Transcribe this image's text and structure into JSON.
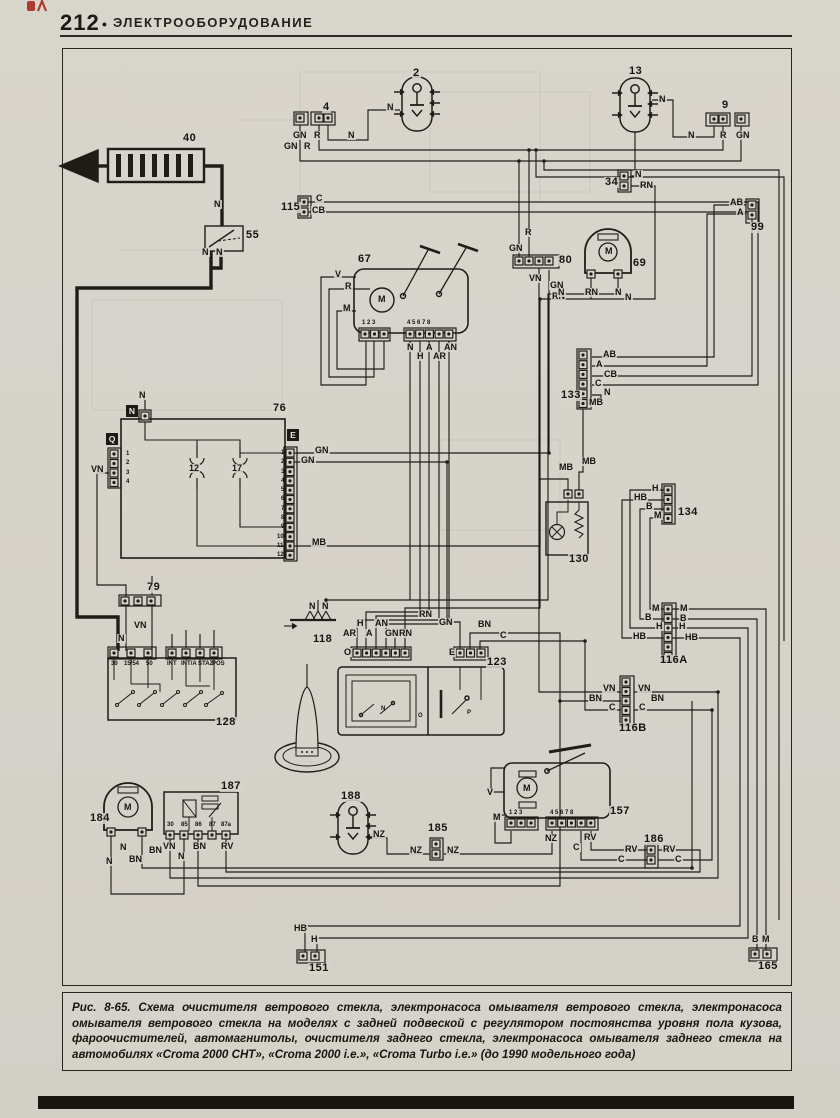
{
  "header": {
    "page_number": "212",
    "separator": "•",
    "section_title": "ЭЛЕКТРООБОРУДОВАНИЕ"
  },
  "figure": {
    "caption": "Рис. 8-65. Схема очистителя ветрового стекла, электронасоса омывателя ветрового стекла, электронасоса омывателя ветрового стекла на моделях с задней подвеской с регулятором постоянства уровня пола кузова, фароочистителей, автомагнитолы, очистителя заднего стекла, электронасоса омывателя заднего стекла на автомобилях «Croma 2000 CHT»,  «Croma 2000 i.e.», «Croma Turbo i.e.» (до 1990 модельного года)"
  },
  "diagram": {
    "ink_color": "#1e1d18",
    "paper_color": "#d6d3cb",
    "component_numbers": [
      {
        "t": "2",
        "x": 412,
        "y": 68
      },
      {
        "t": "4",
        "x": 322,
        "y": 102
      },
      {
        "t": "9",
        "x": 721,
        "y": 100
      },
      {
        "t": "13",
        "x": 628,
        "y": 66
      },
      {
        "t": "34",
        "x": 604,
        "y": 177
      },
      {
        "t": "40",
        "x": 182,
        "y": 133
      },
      {
        "t": "55",
        "x": 245,
        "y": 230
      },
      {
        "t": "67",
        "x": 357,
        "y": 254
      },
      {
        "t": "69",
        "x": 632,
        "y": 258
      },
      {
        "t": "76",
        "x": 272,
        "y": 403
      },
      {
        "t": "79",
        "x": 146,
        "y": 582
      },
      {
        "t": "80",
        "x": 558,
        "y": 255
      },
      {
        "t": "99",
        "x": 750,
        "y": 222
      },
      {
        "t": "115",
        "x": 280,
        "y": 202
      },
      {
        "t": "116A",
        "x": 659,
        "y": 655
      },
      {
        "t": "116B",
        "x": 618,
        "y": 723
      },
      {
        "t": "118",
        "x": 312,
        "y": 634
      },
      {
        "t": "123",
        "x": 486,
        "y": 657
      },
      {
        "t": "128",
        "x": 215,
        "y": 717
      },
      {
        "t": "130",
        "x": 568,
        "y": 554
      },
      {
        "t": "133",
        "x": 560,
        "y": 390
      },
      {
        "t": "134",
        "x": 677,
        "y": 507
      },
      {
        "t": "151",
        "x": 308,
        "y": 963
      },
      {
        "t": "157",
        "x": 609,
        "y": 806
      },
      {
        "t": "165",
        "x": 757,
        "y": 961
      },
      {
        "t": "184",
        "x": 89,
        "y": 813
      },
      {
        "t": "185",
        "x": 427,
        "y": 823
      },
      {
        "t": "186",
        "x": 643,
        "y": 834
      },
      {
        "t": "187",
        "x": 220,
        "y": 781
      },
      {
        "t": "188",
        "x": 340,
        "y": 791
      }
    ],
    "wire_labels": [
      {
        "t": "N",
        "x": 386,
        "y": 103
      },
      {
        "t": "N",
        "x": 347,
        "y": 131
      },
      {
        "t": "GN",
        "x": 292,
        "y": 131
      },
      {
        "t": "R",
        "x": 313,
        "y": 131
      },
      {
        "t": "GN",
        "x": 283,
        "y": 142
      },
      {
        "t": "R",
        "x": 303,
        "y": 142
      },
      {
        "t": "N",
        "x": 658,
        "y": 95
      },
      {
        "t": "N",
        "x": 687,
        "y": 131
      },
      {
        "t": "R",
        "x": 719,
        "y": 131
      },
      {
        "t": "GN",
        "x": 735,
        "y": 131
      },
      {
        "t": "N",
        "x": 634,
        "y": 170
      },
      {
        "t": "RN",
        "x": 639,
        "y": 181
      },
      {
        "t": "AB",
        "x": 729,
        "y": 198
      },
      {
        "t": "A",
        "x": 736,
        "y": 208
      },
      {
        "t": "C",
        "x": 315,
        "y": 194
      },
      {
        "t": "CB",
        "x": 311,
        "y": 206
      },
      {
        "t": "N",
        "x": 213,
        "y": 200
      },
      {
        "t": "N",
        "x": 201,
        "y": 248
      },
      {
        "t": "N",
        "x": 215,
        "y": 248
      },
      {
        "t": "V",
        "x": 334,
        "y": 270
      },
      {
        "t": "R",
        "x": 344,
        "y": 282
      },
      {
        "t": "M",
        "x": 342,
        "y": 304
      },
      {
        "t": "N",
        "x": 406,
        "y": 343
      },
      {
        "t": "H",
        "x": 416,
        "y": 352
      },
      {
        "t": "A",
        "x": 425,
        "y": 343
      },
      {
        "t": "AR",
        "x": 432,
        "y": 352
      },
      {
        "t": "AN",
        "x": 443,
        "y": 343
      },
      {
        "t": "R",
        "x": 524,
        "y": 228
      },
      {
        "t": "GN",
        "x": 508,
        "y": 244
      },
      {
        "t": "VN",
        "x": 528,
        "y": 274
      },
      {
        "t": "GN",
        "x": 549,
        "y": 281
      },
      {
        "t": "RN",
        "x": 551,
        "y": 292
      },
      {
        "t": "RN",
        "x": 584,
        "y": 288
      },
      {
        "t": "N",
        "x": 557,
        "y": 288
      },
      {
        "t": "N",
        "x": 614,
        "y": 288
      },
      {
        "t": "N",
        "x": 624,
        "y": 293
      },
      {
        "t": "GN",
        "x": 314,
        "y": 446
      },
      {
        "t": "GN",
        "x": 300,
        "y": 456
      },
      {
        "t": "VN",
        "x": 90,
        "y": 465
      },
      {
        "t": "MB",
        "x": 311,
        "y": 538
      },
      {
        "t": "N",
        "x": 138,
        "y": 391
      },
      {
        "t": "12",
        "x": 188,
        "y": 464
      },
      {
        "t": "17",
        "x": 231,
        "y": 464
      },
      {
        "t": "AB",
        "x": 602,
        "y": 350
      },
      {
        "t": "A",
        "x": 595,
        "y": 360
      },
      {
        "t": "CB",
        "x": 603,
        "y": 370
      },
      {
        "t": "C",
        "x": 594,
        "y": 379
      },
      {
        "t": "N",
        "x": 603,
        "y": 388
      },
      {
        "t": "MB",
        "x": 588,
        "y": 398
      },
      {
        "t": "MB",
        "x": 558,
        "y": 463
      },
      {
        "t": "MB",
        "x": 581,
        "y": 457
      },
      {
        "t": "H",
        "x": 651,
        "y": 484
      },
      {
        "t": "HB",
        "x": 633,
        "y": 493
      },
      {
        "t": "B",
        "x": 645,
        "y": 502
      },
      {
        "t": "M",
        "x": 653,
        "y": 511
      },
      {
        "t": "M",
        "x": 651,
        "y": 604
      },
      {
        "t": "M",
        "x": 679,
        "y": 604
      },
      {
        "t": "B",
        "x": 644,
        "y": 613
      },
      {
        "t": "B",
        "x": 679,
        "y": 614
      },
      {
        "t": "H",
        "x": 655,
        "y": 622
      },
      {
        "t": "H",
        "x": 678,
        "y": 622
      },
      {
        "t": "HB",
        "x": 632,
        "y": 632
      },
      {
        "t": "HB",
        "x": 684,
        "y": 633
      },
      {
        "t": "VN",
        "x": 602,
        "y": 684
      },
      {
        "t": "VN",
        "x": 637,
        "y": 684
      },
      {
        "t": "BN",
        "x": 588,
        "y": 694
      },
      {
        "t": "BN",
        "x": 650,
        "y": 694
      },
      {
        "t": "C",
        "x": 608,
        "y": 703
      },
      {
        "t": "C",
        "x": 638,
        "y": 703
      },
      {
        "t": "VN",
        "x": 133,
        "y": 621
      },
      {
        "t": "N",
        "x": 117,
        "y": 634
      },
      {
        "t": "N",
        "x": 308,
        "y": 602
      },
      {
        "t": "N",
        "x": 321,
        "y": 602
      },
      {
        "t": "AR",
        "x": 342,
        "y": 629
      },
      {
        "t": "H",
        "x": 356,
        "y": 619
      },
      {
        "t": "A",
        "x": 365,
        "y": 629
      },
      {
        "t": "AN",
        "x": 374,
        "y": 619
      },
      {
        "t": "GN",
        "x": 384,
        "y": 629
      },
      {
        "t": "RN",
        "x": 398,
        "y": 629
      },
      {
        "t": "RN",
        "x": 418,
        "y": 610
      },
      {
        "t": "GN",
        "x": 438,
        "y": 618
      },
      {
        "t": "BN",
        "x": 477,
        "y": 620
      },
      {
        "t": "C",
        "x": 499,
        "y": 631
      },
      {
        "t": "O",
        "x": 343,
        "y": 648
      },
      {
        "t": "E",
        "x": 448,
        "y": 648
      },
      {
        "t": "N",
        "x": 119,
        "y": 843
      },
      {
        "t": "BN",
        "x": 148,
        "y": 846
      },
      {
        "t": "N",
        "x": 105,
        "y": 857
      },
      {
        "t": "BN",
        "x": 128,
        "y": 855
      },
      {
        "t": "VN",
        "x": 162,
        "y": 842
      },
      {
        "t": "N",
        "x": 177,
        "y": 852
      },
      {
        "t": "BN",
        "x": 192,
        "y": 842
      },
      {
        "t": "RV",
        "x": 220,
        "y": 842
      },
      {
        "t": "NZ",
        "x": 372,
        "y": 830
      },
      {
        "t": "NZ",
        "x": 409,
        "y": 846
      },
      {
        "t": "NZ",
        "x": 446,
        "y": 846
      },
      {
        "t": "V",
        "x": 486,
        "y": 788
      },
      {
        "t": "M",
        "x": 492,
        "y": 813
      },
      {
        "t": "NZ",
        "x": 544,
        "y": 834
      },
      {
        "t": "RV",
        "x": 583,
        "y": 833
      },
      {
        "t": "C",
        "x": 572,
        "y": 843
      },
      {
        "t": "RV",
        "x": 624,
        "y": 845
      },
      {
        "t": "RV",
        "x": 662,
        "y": 845
      },
      {
        "t": "C",
        "x": 617,
        "y": 855
      },
      {
        "t": "C",
        "x": 674,
        "y": 855
      },
      {
        "t": "HB",
        "x": 293,
        "y": 924
      },
      {
        "t": "H",
        "x": 310,
        "y": 935
      },
      {
        "t": "B",
        "x": 751,
        "y": 935
      },
      {
        "t": "M",
        "x": 761,
        "y": 935
      },
      {
        "t": "M",
        "x": 377,
        "y": 295
      },
      {
        "t": "M",
        "x": 604,
        "y": 247
      },
      {
        "t": "M",
        "x": 123,
        "y": 803
      },
      {
        "t": "M",
        "x": 522,
        "y": 784
      }
    ],
    "tiny_labels": [
      {
        "t": "1 2 3",
        "x": 361,
        "y": 320
      },
      {
        "t": "4 5 6 7 8",
        "x": 406,
        "y": 320
      },
      {
        "t": "1 2 3",
        "x": 508,
        "y": 810
      },
      {
        "t": "4 5 6 7 8",
        "x": 549,
        "y": 810
      },
      {
        "t": "30",
        "x": 110,
        "y": 661
      },
      {
        "t": "15/54",
        "x": 123,
        "y": 661
      },
      {
        "t": "50",
        "x": 145,
        "y": 661
      },
      {
        "t": "INT",
        "x": 166,
        "y": 661
      },
      {
        "t": "INT/A",
        "x": 180,
        "y": 661
      },
      {
        "t": "STAZ",
        "x": 197,
        "y": 661
      },
      {
        "t": "POS",
        "x": 211,
        "y": 661
      },
      {
        "t": "30",
        "x": 166,
        "y": 822
      },
      {
        "t": "85",
        "x": 180,
        "y": 822
      },
      {
        "t": "86",
        "x": 194,
        "y": 822
      },
      {
        "t": "87",
        "x": 208,
        "y": 822
      },
      {
        "t": "87a",
        "x": 220,
        "y": 822
      },
      {
        "t": "1",
        "x": 125,
        "y": 451
      },
      {
        "t": "2",
        "x": 125,
        "y": 460
      },
      {
        "t": "3",
        "x": 125,
        "y": 470
      },
      {
        "t": "4",
        "x": 125,
        "y": 479
      },
      {
        "t": "1",
        "x": 280,
        "y": 450
      },
      {
        "t": "2",
        "x": 280,
        "y": 459
      },
      {
        "t": "3",
        "x": 280,
        "y": 469
      },
      {
        "t": "4",
        "x": 280,
        "y": 478
      },
      {
        "t": "5",
        "x": 280,
        "y": 487
      },
      {
        "t": "6",
        "x": 280,
        "y": 496
      },
      {
        "t": "7",
        "x": 280,
        "y": 506
      },
      {
        "t": "8",
        "x": 280,
        "y": 515
      },
      {
        "t": "9",
        "x": 280,
        "y": 524
      },
      {
        "t": "10",
        "x": 276,
        "y": 534
      },
      {
        "t": "11",
        "x": 276,
        "y": 543
      },
      {
        "t": "12",
        "x": 276,
        "y": 552
      },
      {
        "t": "N",
        "x": 380,
        "y": 706
      },
      {
        "t": "O",
        "x": 417,
        "y": 713
      },
      {
        "t": "P",
        "x": 466,
        "y": 710
      }
    ],
    "badges": [
      {
        "t": "N",
        "x": 126,
        "y": 405
      },
      {
        "t": "Q",
        "x": 106,
        "y": 433
      },
      {
        "t": "E",
        "x": 287,
        "y": 429
      }
    ],
    "wire_codes_legend": [
      "N",
      "R",
      "GN",
      "RN",
      "VN",
      "MB",
      "AB",
      "A",
      "CB",
      "C",
      "H",
      "HB",
      "B",
      "M",
      "BN",
      "RV",
      "NZ",
      "AR",
      "AN",
      "V"
    ]
  }
}
